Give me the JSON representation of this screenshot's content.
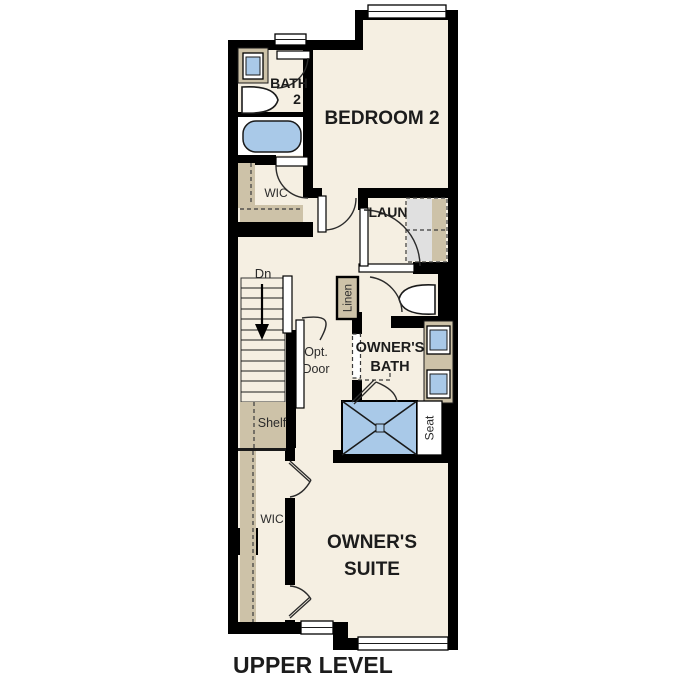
{
  "title": "UPPER LEVEL",
  "colors": {
    "floor": "#F5EFE2",
    "closet": "#CDC2A8",
    "fixture": "#A9C9E8",
    "appliance": "#E0E0E0",
    "wall": "#000000"
  },
  "rooms": {
    "bath2_line1": "BATH",
    "bath2_line2": "2",
    "bedroom2": "BEDROOM 2",
    "wic_upper": "WIC",
    "laundry": "LAUN",
    "owners_bath_line1": "OWNER'S",
    "owners_bath_line2": "BATH",
    "owners_suite_line1": "OWNER'S",
    "owners_suite_line2": "SUITE",
    "wic_lower": "WIC"
  },
  "annotations": {
    "down": "Dn",
    "linen": "Linen",
    "opt_door_line1": "Opt.",
    "opt_door_line2": "Door",
    "shelf": "Shelf",
    "seat": "Seat"
  }
}
